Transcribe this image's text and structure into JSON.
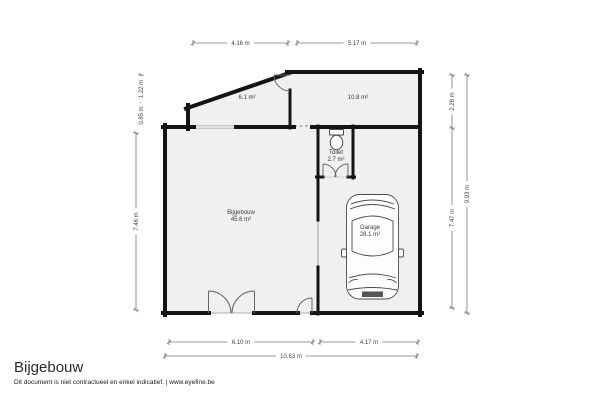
{
  "plan": {
    "rooms": {
      "room_upper_left": {
        "area": "6.1 m²"
      },
      "room_upper_right": {
        "area": "10.8 m²"
      },
      "toilet": {
        "name": "Toilet",
        "area": "2.7 m²"
      },
      "bijgebouw": {
        "name": "Bijgebouw",
        "area": "45.6 m²"
      },
      "garage": {
        "name": "Garage",
        "area": "28.1 m²"
      }
    },
    "dimensions": {
      "top": [
        "4.16 m",
        "5.17 m"
      ],
      "bottom_inner": [
        "6.10 m",
        "4.17 m"
      ],
      "bottom_outer": "10.63 m",
      "left_upper": [
        "1.22 m",
        "0.85 m"
      ],
      "left_lower": "7.46 m",
      "right_inner": [
        "2.28 m",
        "7.47 m"
      ],
      "right_outer": "9.93 m"
    }
  },
  "footer": {
    "title": "Bijgebouw",
    "disclaimer": "Dit document is niet contractueel en enkel indicatief. | www.eyefine.be"
  },
  "colors": {
    "background": "#ffffff",
    "room_fill": "#f0f0f0",
    "wall": "#141414",
    "dimension": "#777777",
    "door": "#666666",
    "fixture": "#4a4a4a"
  }
}
